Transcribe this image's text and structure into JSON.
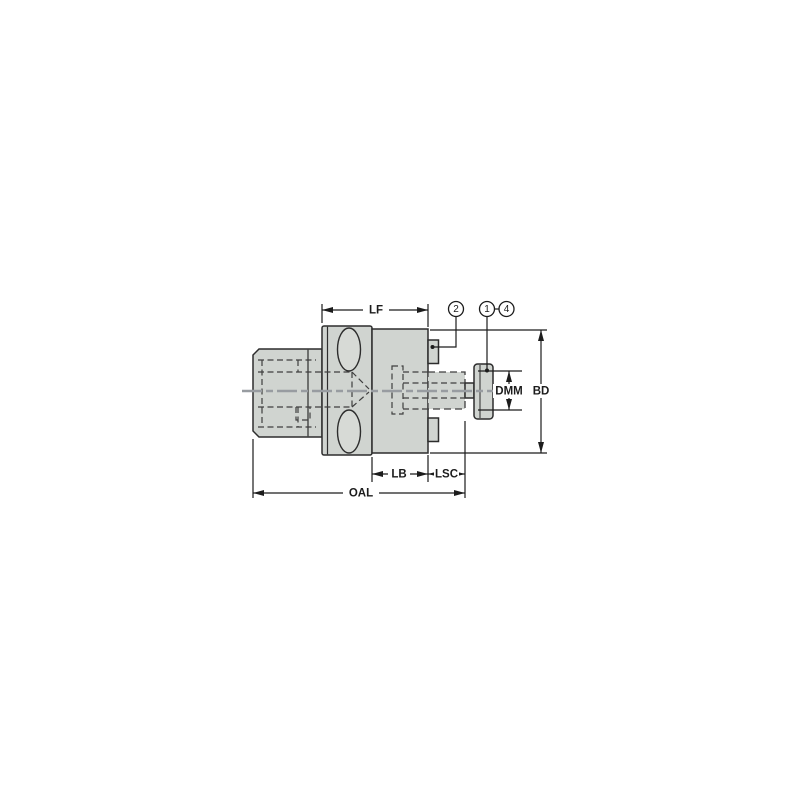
{
  "diagram": {
    "type": "technical-drawing",
    "subject": "tool-holder-side-view-with-dimensions",
    "dimensions": [
      {
        "id": "lf",
        "label": "LF"
      },
      {
        "id": "lb",
        "label": "LB"
      },
      {
        "id": "lsc",
        "label": "LSC"
      },
      {
        "id": "oal",
        "label": "OAL"
      },
      {
        "id": "dmm",
        "label": "DMM"
      },
      {
        "id": "bd",
        "label": "BD"
      }
    ],
    "callouts": [
      {
        "label": "2"
      },
      {
        "label": "1"
      },
      {
        "label": "4"
      }
    ]
  },
  "colors": {
    "background": "#ffffff",
    "part_fill": "#d0d4d0",
    "slot_fill": "#d7dad6",
    "outline": "#2d2d2d",
    "hidden_line": "#3f3f3f",
    "center_line": "#989ca1",
    "dimension": "#1c1c1c"
  }
}
